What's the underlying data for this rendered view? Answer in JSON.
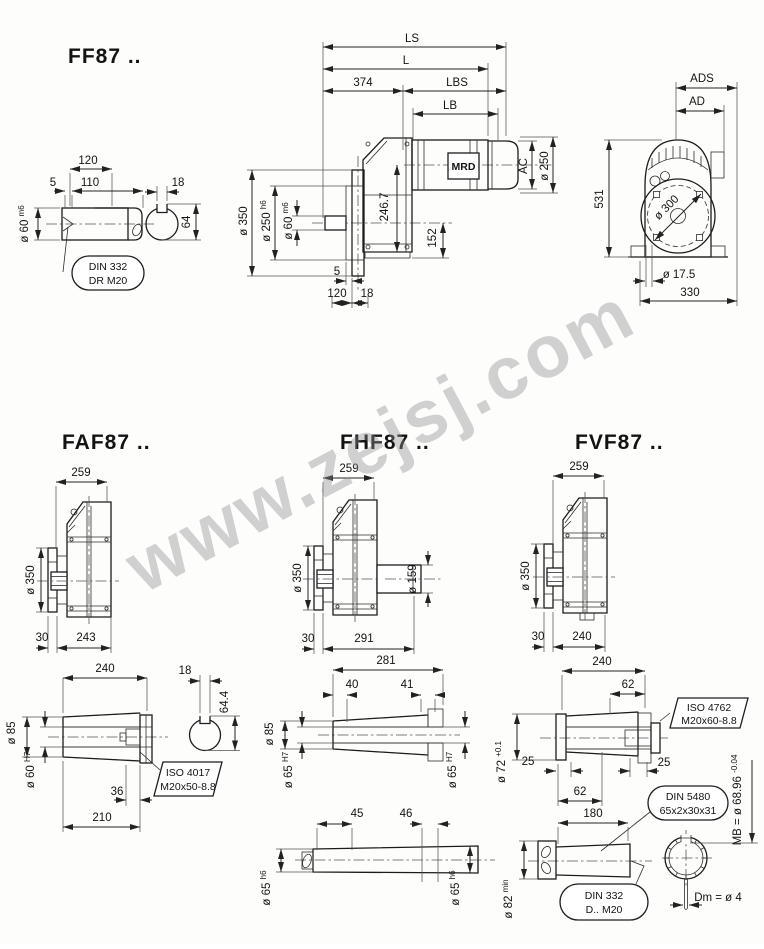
{
  "watermark": "www.zejsj.com",
  "ff": {
    "title": "FF87 ..",
    "shaft": {
      "d120": "120",
      "d5": "5",
      "d110": "110",
      "key_w": "18",
      "key_h": "64",
      "dia": "ø 60",
      "dia_suf": "m6",
      "callout1": "DIN 332",
      "callout2": "DR M20"
    },
    "side": {
      "ls": "LS",
      "l": "L",
      "d374": "374",
      "lbs": "LBS",
      "lb": "LB",
      "motor": "MRD",
      "ac": "AC",
      "dia250": "ø 250",
      "dia350": "ø 350",
      "dia250h6": "ø 250",
      "dia250h6_suf": "h6",
      "dia60": "ø 60",
      "dia60_suf": "m6",
      "h2467": "246.7",
      "h152": "152",
      "d5": "5",
      "d120": "120",
      "d18": "18"
    },
    "front": {
      "ads": "ADS",
      "ad": "AD",
      "h531": "531",
      "dia300": "ø 300",
      "dia175": "ø 17.5",
      "w330": "330"
    }
  },
  "faf": {
    "title": "FAF87 ..",
    "view": {
      "w259": "259",
      "dia350": "ø 350",
      "d30": "30",
      "d243": "243"
    },
    "shaft": {
      "l240": "240",
      "key_w": "18",
      "key_h": "64.4",
      "dia85": "ø 85",
      "dia60": "ø 60",
      "dia60_suf": "H7",
      "callout1": "ISO 4017",
      "callout2": "M20x50-8.8",
      "d36": "36",
      "d210": "210"
    }
  },
  "fhf": {
    "title": "FHF87 ..",
    "view": {
      "w259": "259",
      "dia350": "ø 350",
      "dia159": "ø 159",
      "d30": "30",
      "d291": "291"
    },
    "hollow": {
      "l281": "281",
      "d40": "40",
      "d41": "41",
      "dia85": "ø 85",
      "dia65L": "ø 65",
      "dia65L_suf": "H7",
      "dia65R": "ø 65",
      "dia65R_suf": "H7"
    },
    "solid": {
      "d45": "45",
      "d46": "46",
      "dia65L": "ø 65",
      "dia65L_suf": "h6",
      "dia65R": "ø 65",
      "dia65R_suf": "h6"
    }
  },
  "fvf": {
    "title": "FVF87 ..",
    "view": {
      "w259": "259",
      "dia350": "ø 350",
      "d30": "30",
      "d240": "240"
    },
    "hollow": {
      "l240": "240",
      "d62t": "62",
      "d25l": "25",
      "d25r": "25",
      "d62b": "62",
      "dia72": "ø 72",
      "dia72_suf": "+0.1",
      "iso1": "ISO 4762",
      "iso2": "M20x60-8.8",
      "din1": "DIN 5480",
      "din2": "65x2x30x31"
    },
    "solid": {
      "l180": "180",
      "dia82": "ø 82",
      "dia82_suf": "min",
      "din1": "DIN 332",
      "din2": "D.. M20",
      "mb": "MB = ø 68.96",
      "mb_suf": "-0.04",
      "dm": "Dm = ø 4"
    }
  }
}
